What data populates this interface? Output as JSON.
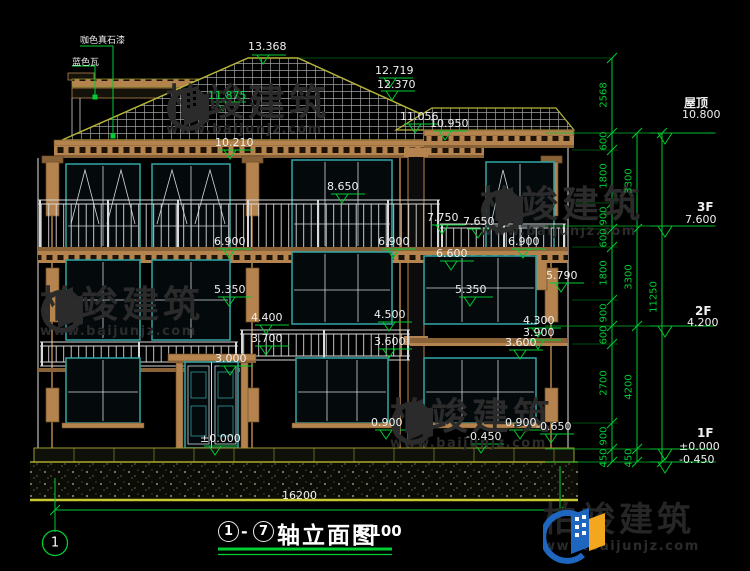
{
  "drawing": {
    "type": "building-elevation",
    "background": "#000000",
    "accent_green": "#00cc33",
    "line_white": "#e8e8e8",
    "window_teal": "#2f9e9e",
    "trim_tan": "#b5834e",
    "edge_olive": "#a8a832"
  },
  "materials": [
    "咖色真石漆",
    "蓝色瓦"
  ],
  "levels": [
    "13.368",
    "12.719",
    "12.370",
    "11.875",
    "11.056",
    "10.950",
    "10.210",
    "8.650",
    "7.750",
    "7.650",
    "6.900",
    "6.900",
    "6.900",
    "6.600",
    "5.790",
    "5.350",
    "5.350",
    "4.500",
    "4.400",
    "4.300",
    "3.900",
    "3.700",
    "3.600",
    "3.600",
    "3.000",
    "0.900",
    "0.900",
    "-0.450",
    "-0.650",
    "±0.000"
  ],
  "floors": {
    "roof_label": "屋顶",
    "roof_value": "10.800",
    "f3_label": "3F",
    "f3_value": "7.600",
    "f2_label": "2F",
    "f2_value": "4.200",
    "f1_label": "1F",
    "f1_value": "±0.000",
    "f1_value2": "-0.450"
  },
  "chains": {
    "inner": [
      "2568",
      "600",
      "1800",
      "900",
      "600",
      "1800",
      "900",
      "600",
      "2700",
      "900",
      "450"
    ],
    "middle": [
      "3300",
      "3300",
      "4200",
      "450"
    ],
    "outer": [
      "11250"
    ]
  },
  "bottom": {
    "total_width": "16200",
    "axis_bubble": "1"
  },
  "title": {
    "axis_from": "1",
    "dash": "-",
    "axis_to": "7",
    "name": "轴立面图",
    "scale": "1:100"
  },
  "watermark": {
    "brand": "柏竣建筑",
    "url": "www.baijunjz.com"
  },
  "footer": {
    "brand": "柏竣建筑",
    "url": "www.baijunjz.com"
  }
}
